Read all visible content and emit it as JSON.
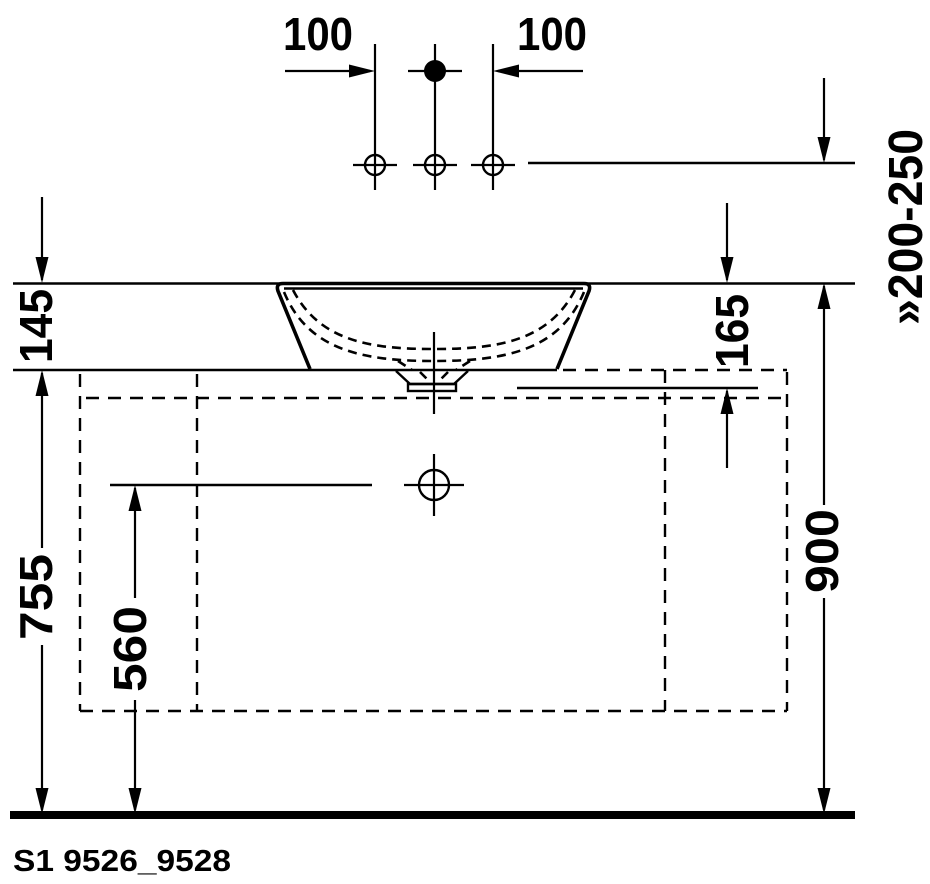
{
  "drawing": {
    "product_code": "S1 9526_9528",
    "dimensions": {
      "tap_spacing_left": "100",
      "tap_spacing_right": "100",
      "rim_above_counter": "145",
      "rim_to_console_underside": "165",
      "tap_height_range": "»200-250",
      "outlet_height": "560",
      "counter_height": "755",
      "rim_height": "900"
    },
    "colors": {
      "line": "#000000",
      "background": "#ffffff"
    }
  }
}
